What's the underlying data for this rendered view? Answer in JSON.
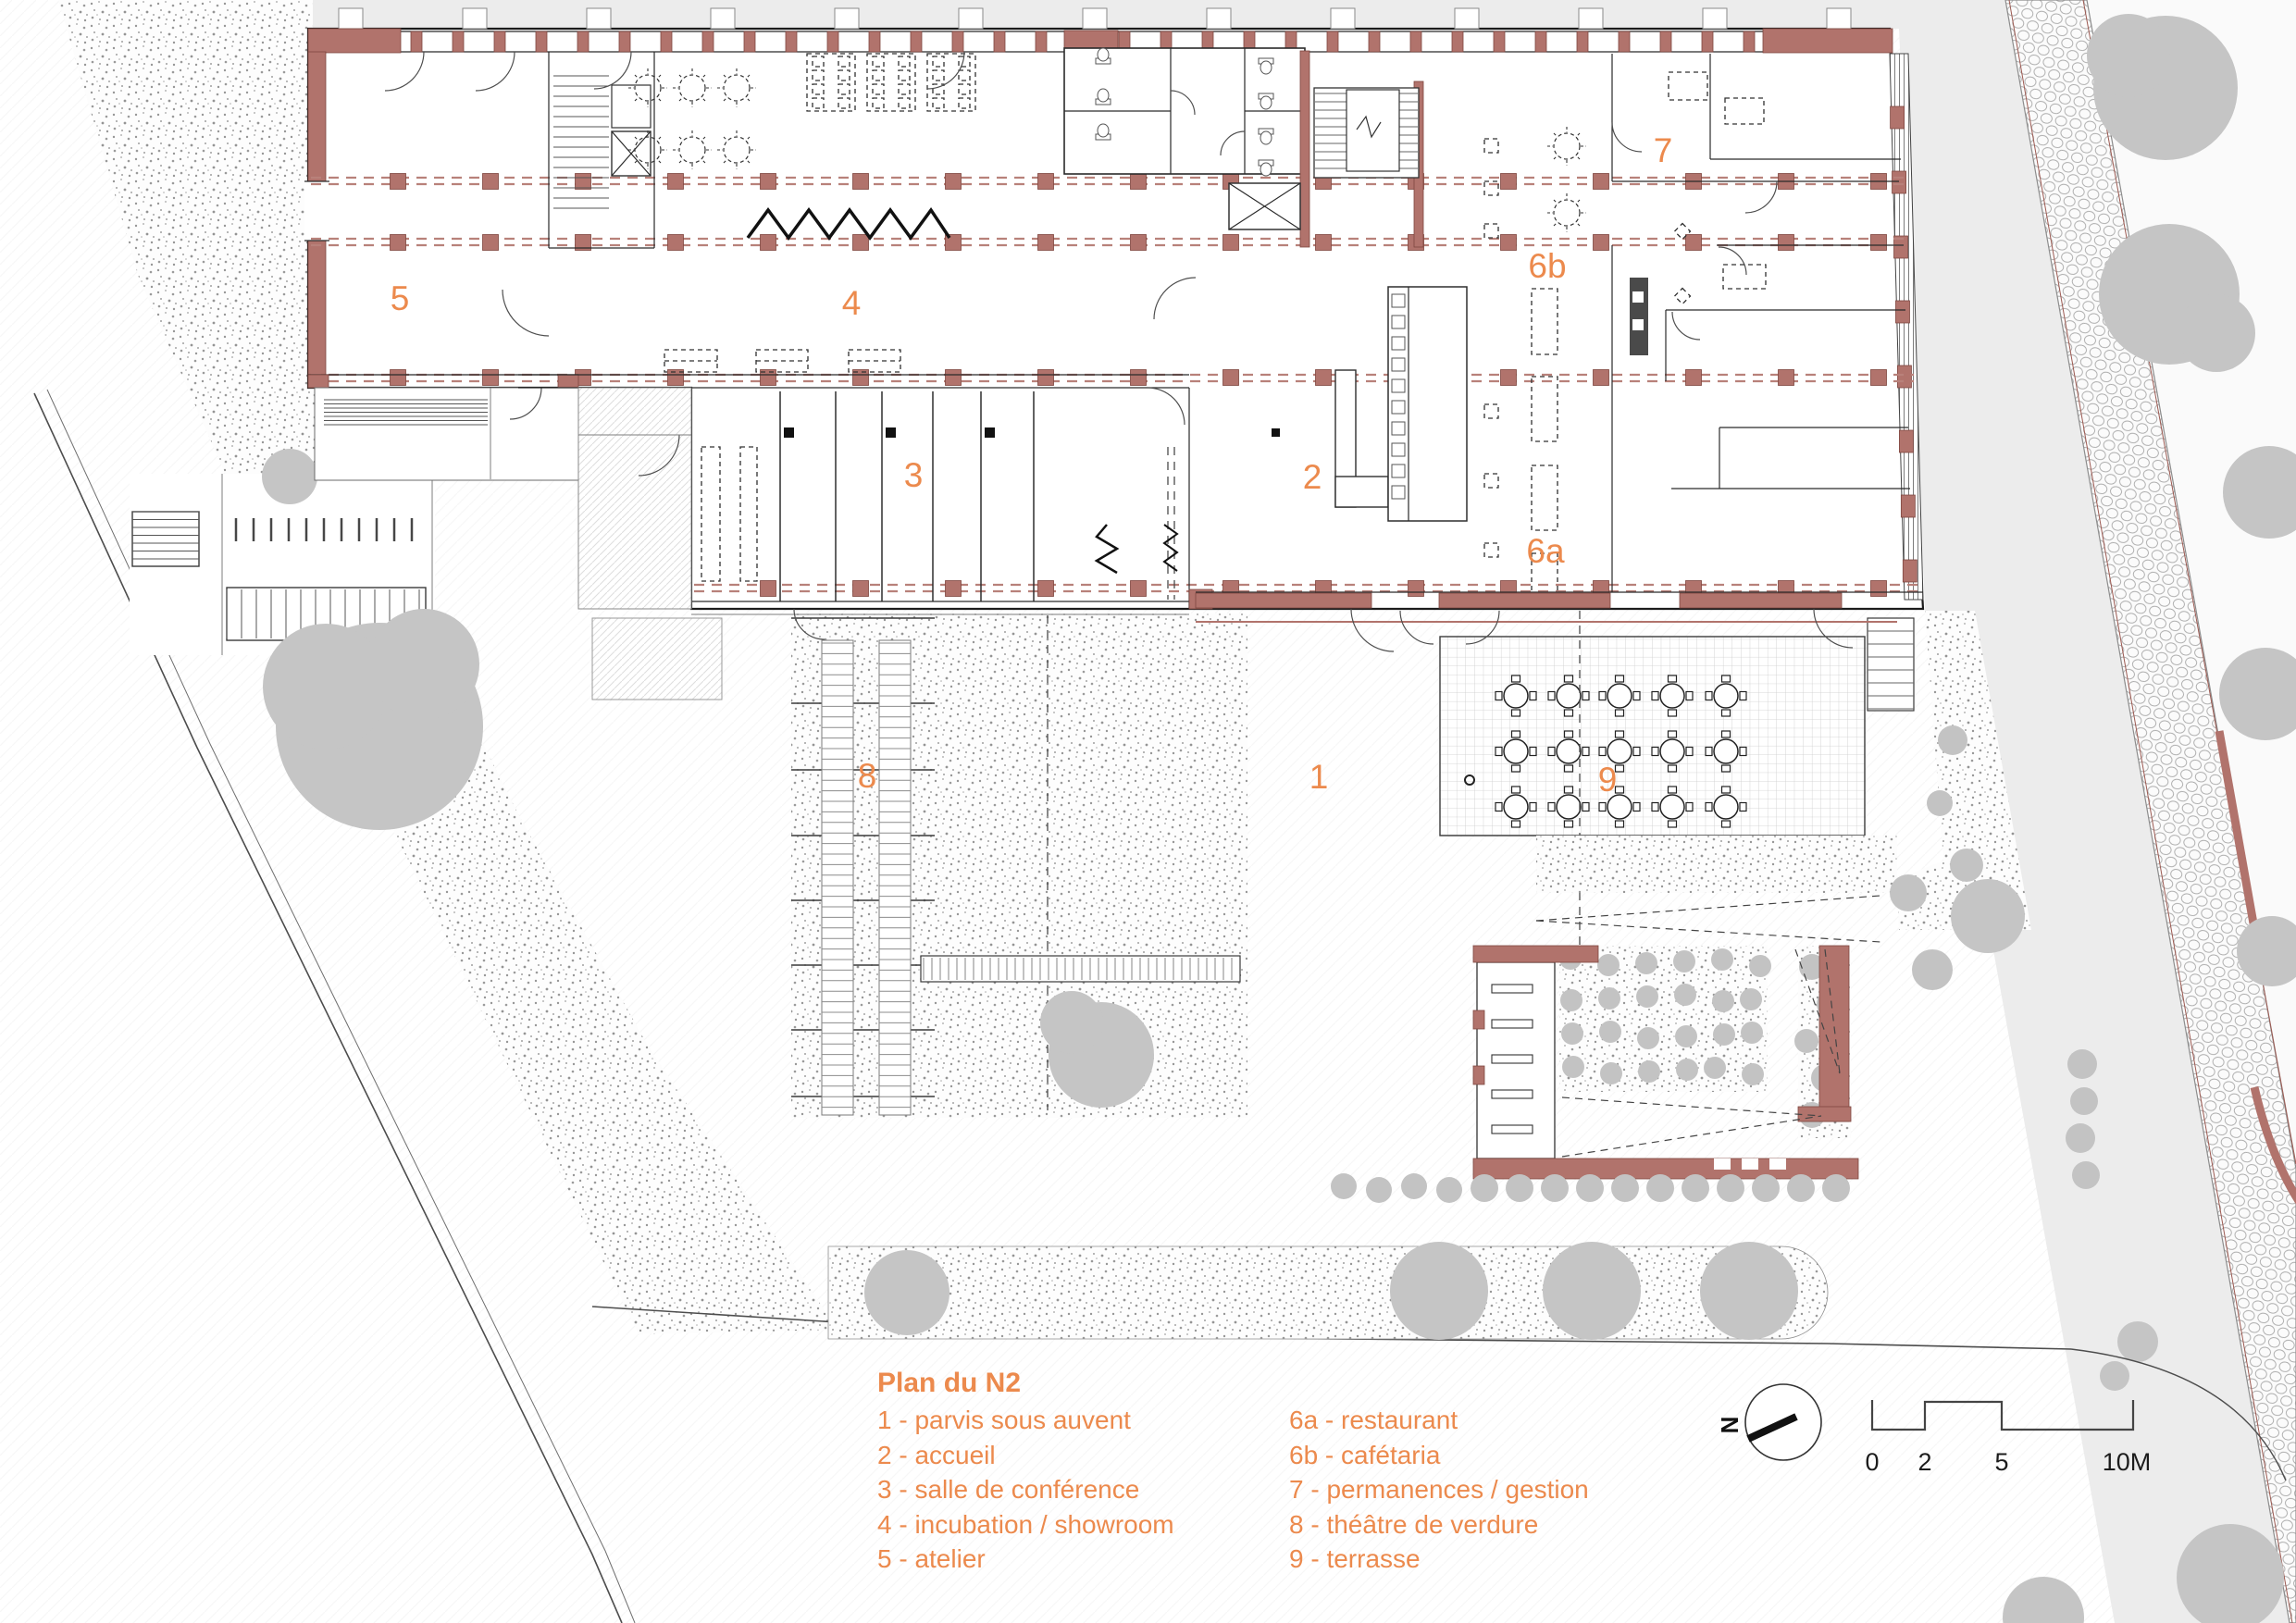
{
  "legend": {
    "title": "Plan du N2",
    "col1": [
      "1 - parvis sous auvent",
      "2 - accueil",
      "3 - salle de conférence",
      "4 - incubation / showroom",
      "5 - atelier"
    ],
    "col2": [
      "6a - restaurant",
      "6b - cafétaria",
      "7 - permanences / gestion",
      "8 - théâtre de verdure",
      "9 - terrasse"
    ]
  },
  "rooms": [
    {
      "label": "1"
    },
    {
      "label": "2"
    },
    {
      "label": "3"
    },
    {
      "label": "4"
    },
    {
      "label": "5"
    },
    {
      "label": "6a"
    },
    {
      "label": "6b"
    },
    {
      "label": "7"
    },
    {
      "label": "8"
    },
    {
      "label": "9"
    }
  ],
  "north": {
    "label": "N"
  },
  "scalebar": {
    "ticks": [
      "0",
      "2",
      "5",
      "10M"
    ]
  },
  "colors": {
    "wall": "#b1736c",
    "accent": "#ec8a4d",
    "tree": "#c5c5c5",
    "grid_dash": "#b8817a",
    "light_gray": "#ececec"
  }
}
